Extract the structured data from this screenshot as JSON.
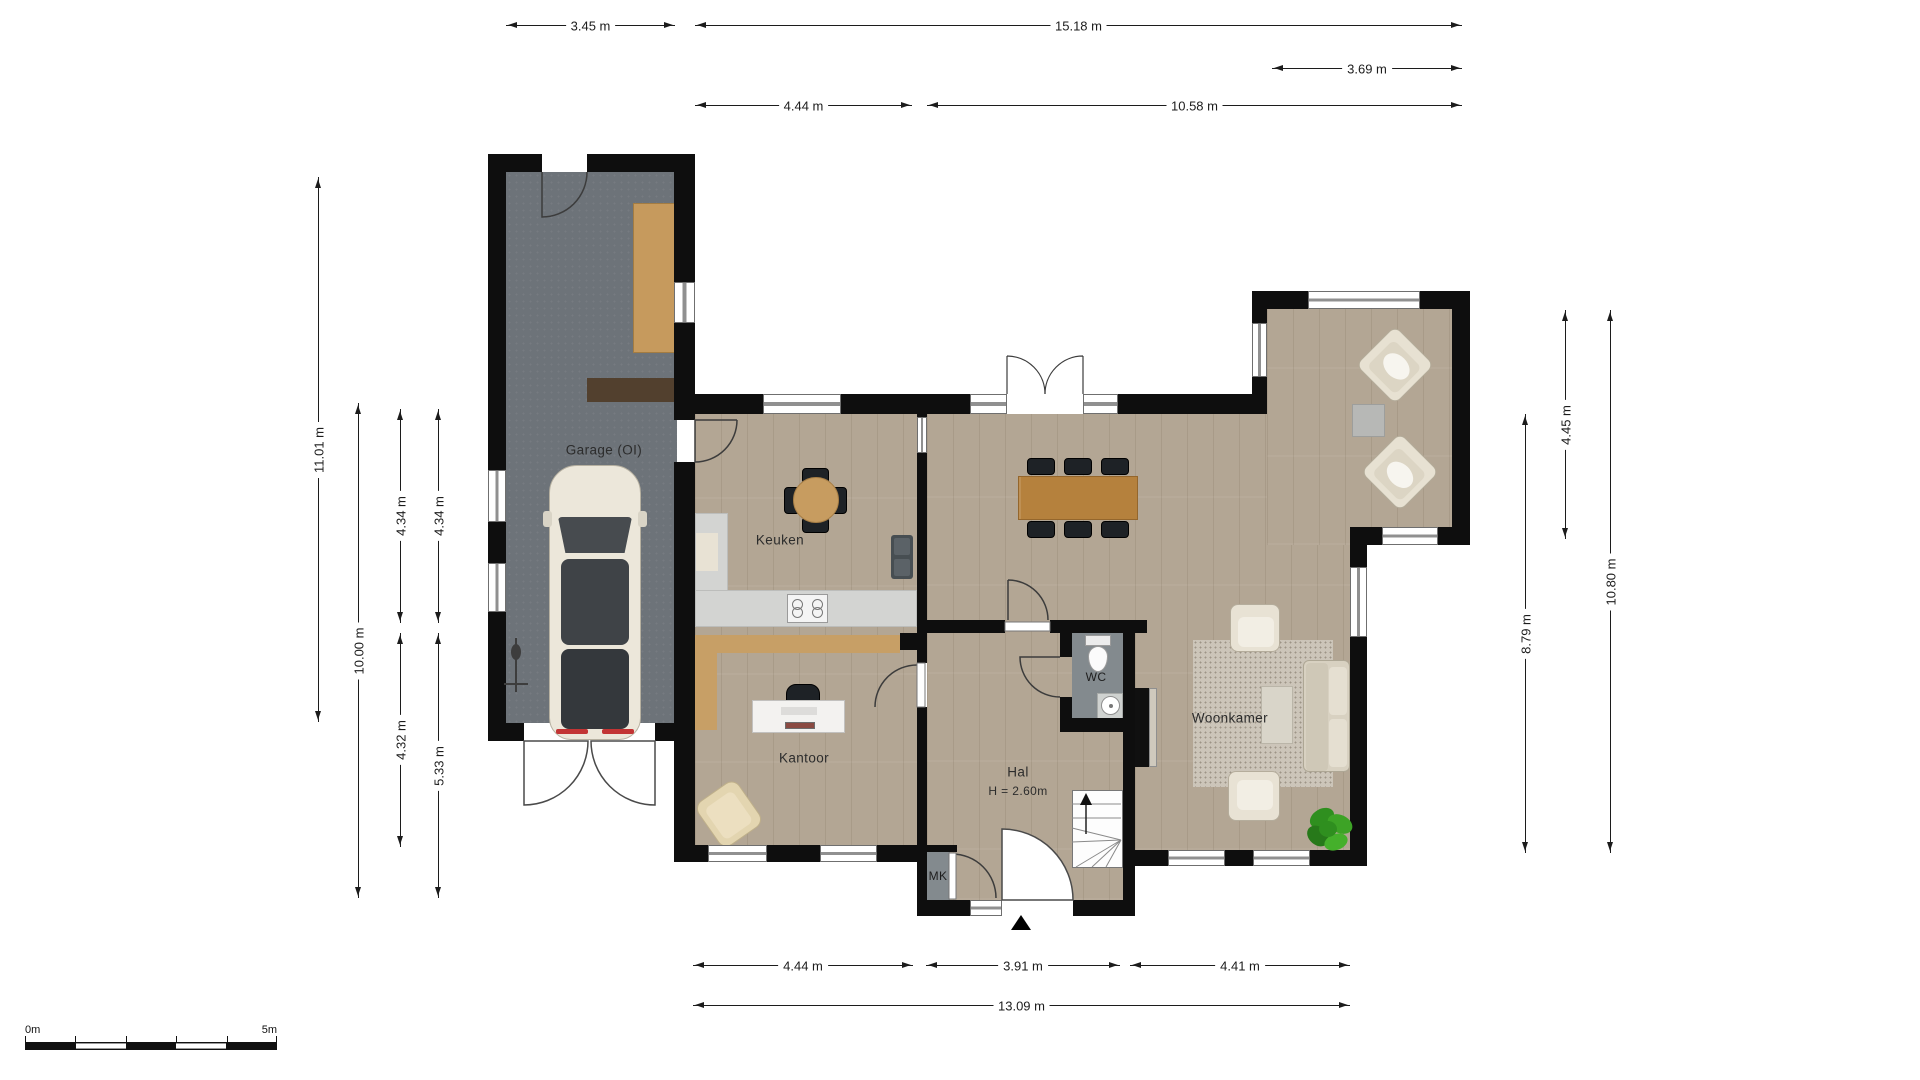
{
  "rooms": {
    "garage": {
      "label": "Garage (OI)"
    },
    "keuken": {
      "label": "Keuken"
    },
    "kantoor": {
      "label": "Kantoor"
    },
    "hal": {
      "label": "Hal",
      "height_note": "H = 2.60m"
    },
    "wc": {
      "label": "WC"
    },
    "woonkamer": {
      "label": "Woonkamer"
    },
    "mk": {
      "label": "MK"
    }
  },
  "dimensions": {
    "top": [
      {
        "label": "3.45 m"
      },
      {
        "label": "15.18 m"
      },
      {
        "label": "3.69 m"
      },
      {
        "label": "4.44 m"
      },
      {
        "label": "10.58 m"
      }
    ],
    "left": [
      {
        "label": "11.01 m"
      },
      {
        "label": "10.00 m"
      },
      {
        "label": "4.34 m"
      },
      {
        "label": "4.34 m"
      },
      {
        "label": "4.32 m"
      },
      {
        "label": "5.33 m"
      }
    ],
    "right": [
      {
        "label": "8.79 m"
      },
      {
        "label": "4.45 m"
      },
      {
        "label": "10.80 m"
      }
    ],
    "bottom": [
      {
        "label": "4.44 m"
      },
      {
        "label": "3.91 m"
      },
      {
        "label": "4.41 m"
      },
      {
        "label": "13.09 m"
      }
    ]
  },
  "scale_bar": {
    "start_label": "0m",
    "end_label": "5m"
  },
  "colors": {
    "wall": "#0e0e0e",
    "wood_floor": "#b3a694",
    "garage_floor": "#6d7379",
    "counter": "#d3d4d2",
    "cabinet_wood": "#c79f66",
    "dining_table": "#b5813d",
    "cream_furniture": "#e8e2d4",
    "plant_green": "#37991f"
  }
}
